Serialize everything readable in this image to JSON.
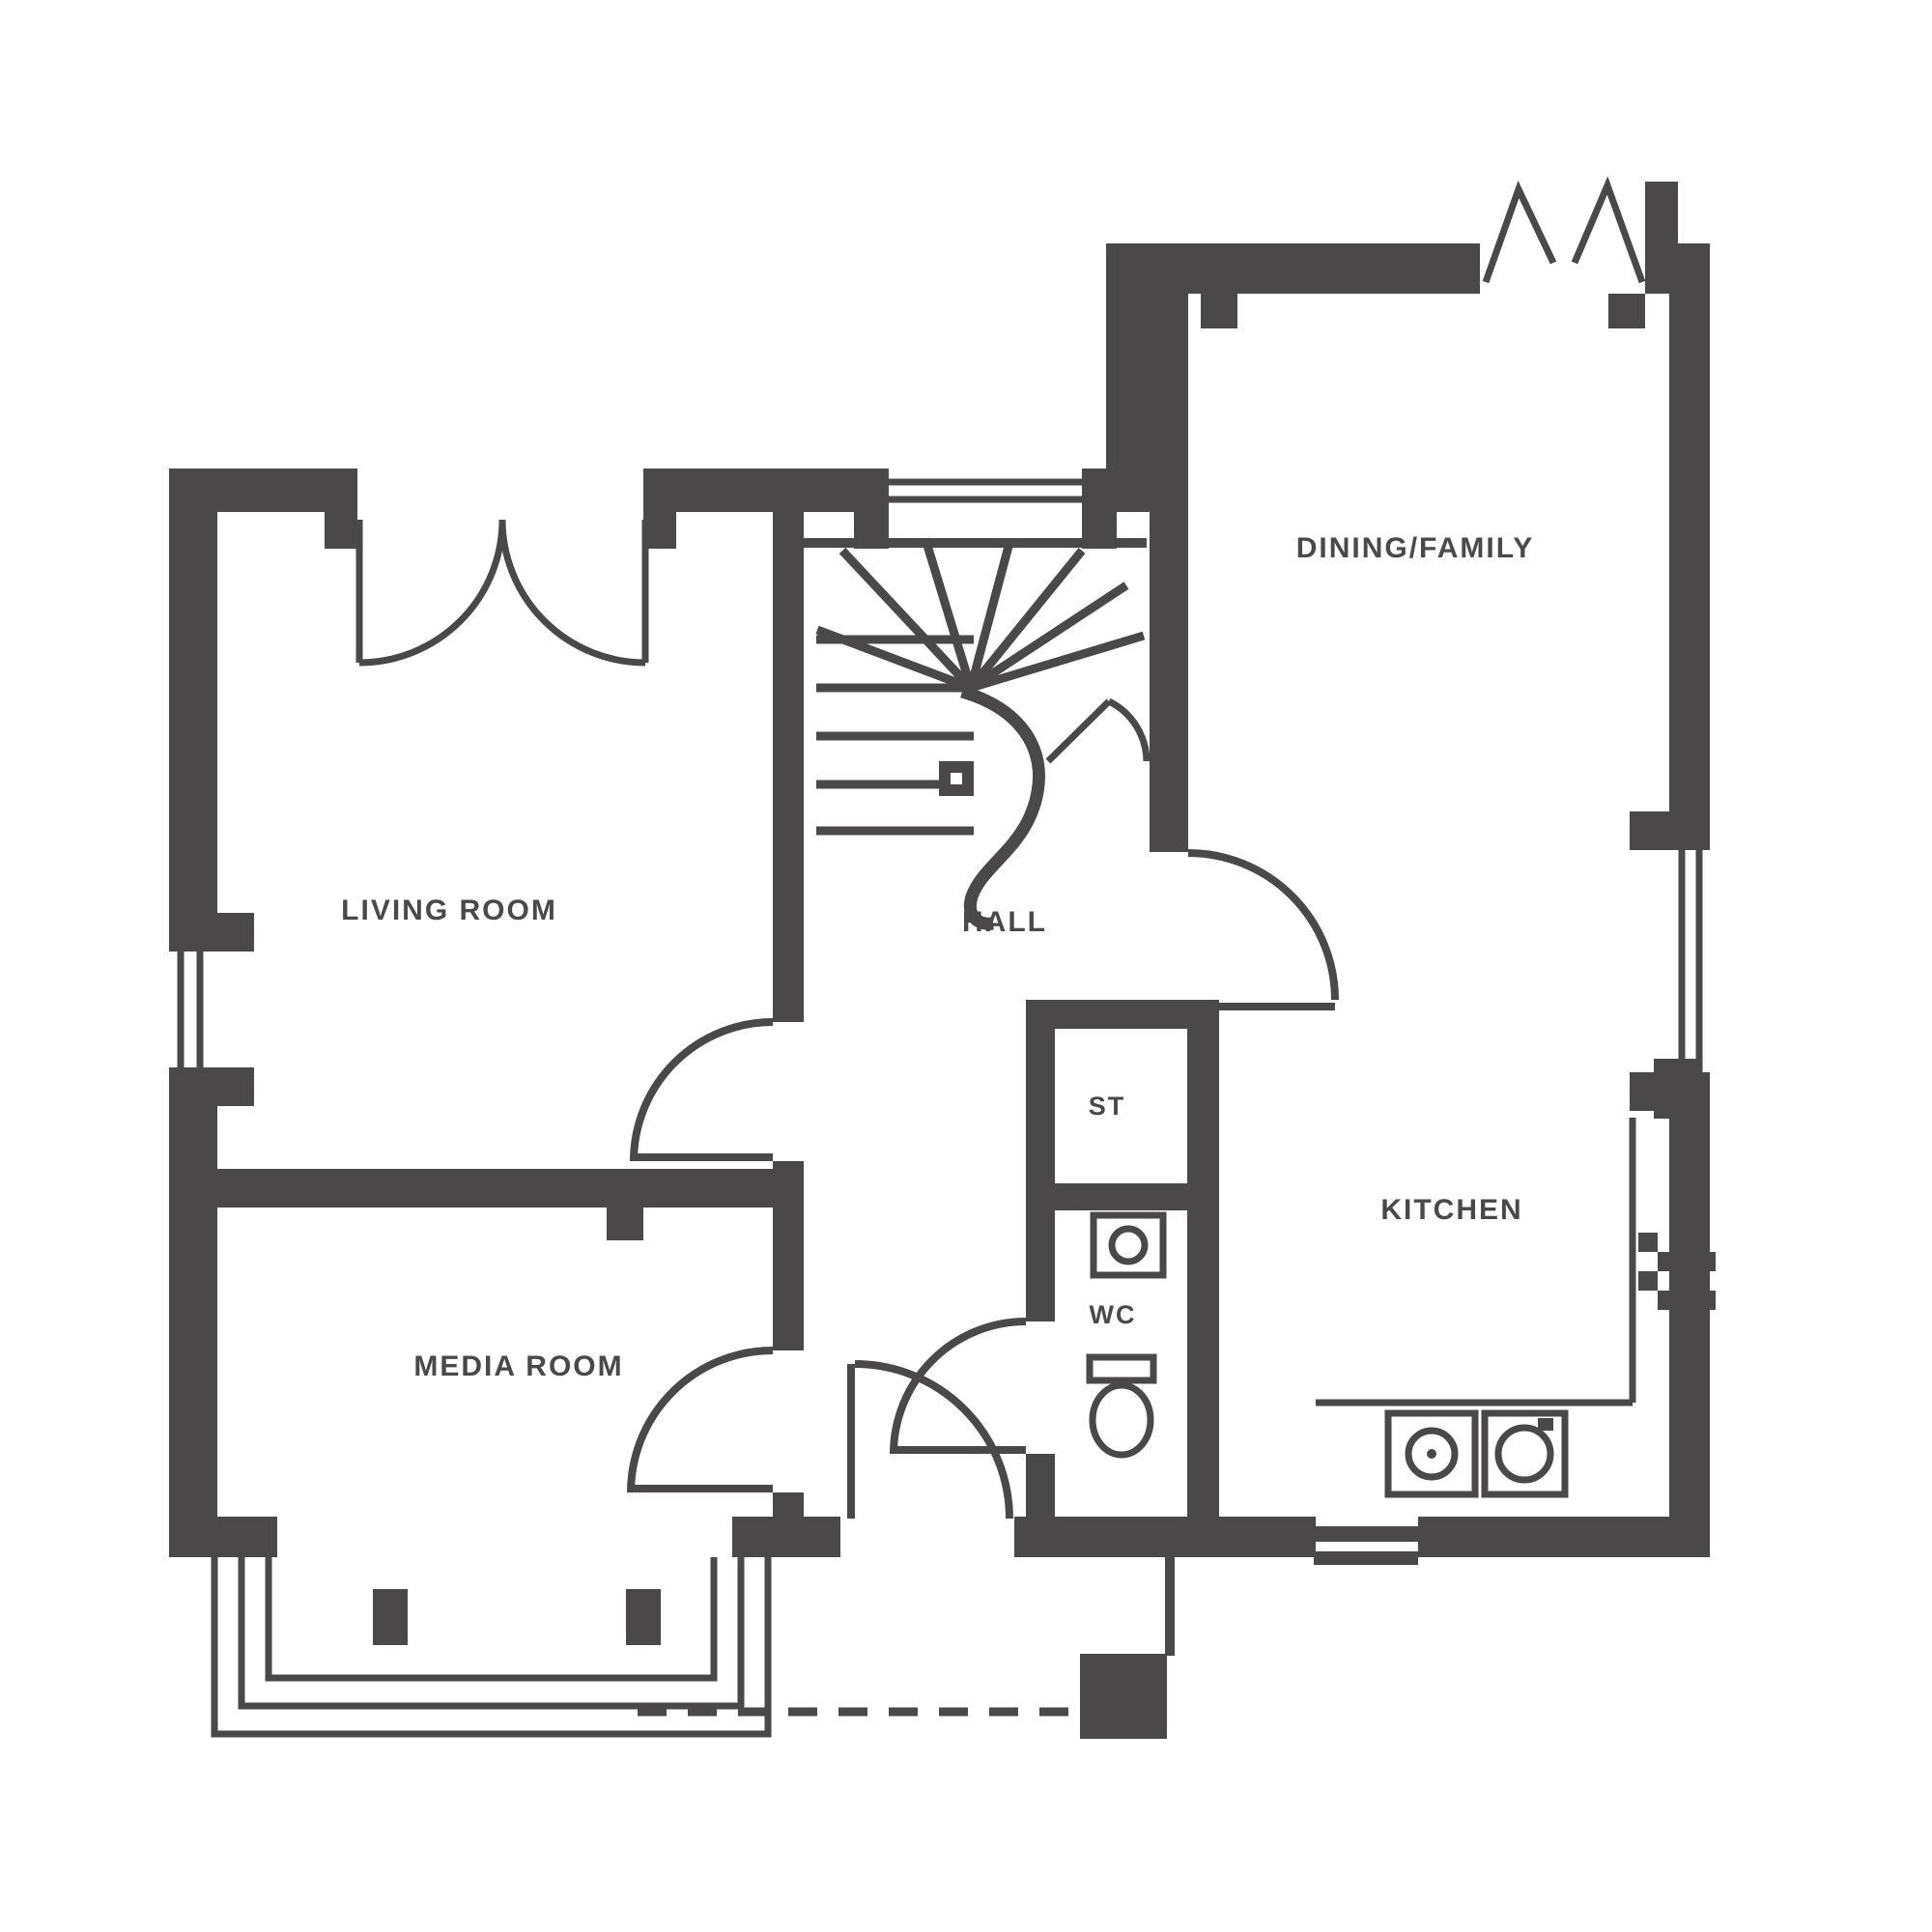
{
  "plan": {
    "wall_color": "#4a4848",
    "background_color": "#ffffff",
    "rooms": {
      "living_room": {
        "label": "LIVING ROOM"
      },
      "media_room": {
        "label": "MEDIA ROOM"
      },
      "dining_family": {
        "label": "DINING/FAMILY"
      },
      "kitchen": {
        "label": "KITCHEN"
      },
      "hall": {
        "label": "HALL"
      },
      "store": {
        "label": "ST"
      },
      "wc": {
        "label": "WC"
      }
    },
    "icons": [
      "winder-staircase-icon",
      "french-doors-icon",
      "patio-doors-open-icon",
      "bay-window-icon",
      "window-icon",
      "door-swing-icon",
      "toilet-icon",
      "basin-icon",
      "hob-icon",
      "appliance-icon",
      "boiler-icon",
      "meter-box-icon",
      "dashed-path-icon"
    ]
  }
}
